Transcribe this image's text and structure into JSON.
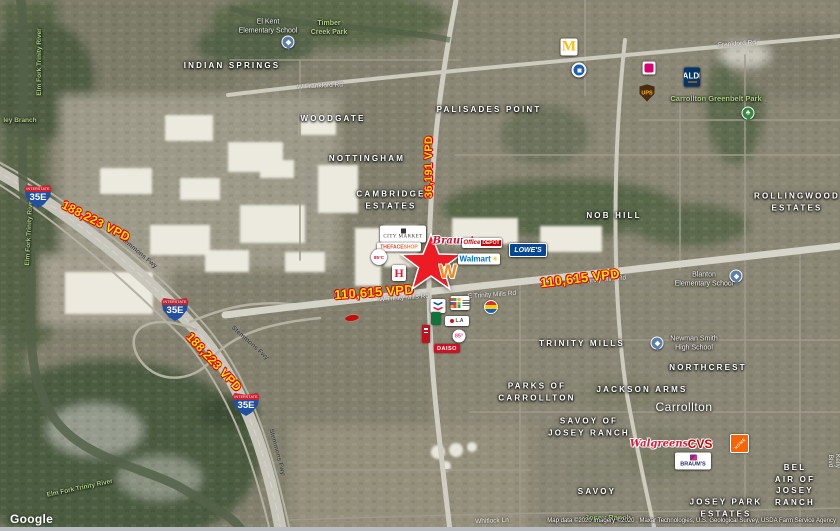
{
  "map": {
    "watermark": "Google",
    "attribution": "Map data ©2020  Imagery ©2020 , Maxar Technologies, U.S. Geological Survey, USDA Farm Service Agency"
  },
  "traffic": {
    "i35e_north": "188,223 VPD",
    "i35e_south": "188,223 VPD",
    "trinity_mills_west": "110,615 VPD",
    "trinity_mills_east": "110,615 VPD",
    "north_south_road": "36,191 VPD"
  },
  "shield": {
    "band": "INTERSTATE",
    "route": "35E"
  },
  "neighborhoods": {
    "indian_springs": "INDIAN SPRINGS",
    "woodgate": "WOODGATE",
    "nottingham": "NOTTINGHAM",
    "cambridge_estates": "CAMBRIDGE\nESTATES",
    "palisades_point": "PALISADES POINT",
    "nob_hill": "NOB HILL",
    "rollingwood_estates": "ROLLINGWOOD\nESTATES",
    "trinity_mills": "TRINITY MILLS",
    "northcrest": "NORTHCREST",
    "parks_of_carrollton": "PARKS OF\nCARROLLTON",
    "jackson_arms": "JACKSON ARMS",
    "savoy_of_josey_ranch": "SAVOY OF\nJOSEY RANCH",
    "savoy": "SAVOY",
    "bel_air_of_josey_ranch": "BEL AIR OF\nJOSEY RANCH",
    "josey_park_estates": "JOSEY PARK\nESTATES",
    "city": "Carrollton"
  },
  "parks": {
    "timber_creek": "Timber\nCreek Park",
    "greenbelt": "Carrollton Greenbelt Park",
    "josey_ranch": "Josey Ranch",
    "elm_fork_1": "Elm Fork Trinity River",
    "elm_fork_2": "Elm Fork Trinity River",
    "elm_fork_3": "Elm Fork Trinity River",
    "ley_branch": "ley Branch"
  },
  "pois": {
    "el_kent": "El Kent\nElementary School",
    "blanton": "Blanton\nElementary School",
    "newman_smith": "Newman Smith\nHigh School"
  },
  "road_labels": {
    "w_frankford": "W Frankford Rd",
    "frankford": "Frankford Rd",
    "w_trinity_mills": "W Trinity Mills Rd",
    "e_trinity_mills_1": "E Trinity Mills Rd",
    "e_trinity_mills_2": "E Trinity Mills Rd",
    "stemmons_1": "Stemmons Fwy",
    "stemmons_2": "Stemmons Fwy",
    "stemmons_3": "Stemmons Fwy",
    "whitlock": "Whitlock Ln",
    "kelly": "Kelly Blvd"
  },
  "brands": {
    "mcdonalds": "M",
    "aldi": "ALDI",
    "ups": "UPS",
    "city_market": "CITY MARKET",
    "faceshop_a": "THEFACE",
    "faceshop_b": "SHOP",
    "cafe_circle": "85°C",
    "hmart": "H",
    "braums_script": "Braum's",
    "office_word": "Office",
    "depot_word": "DEPOT",
    "walmart": "Walmart",
    "walmart_spark": "✶",
    "lowes": "LOWE'S",
    "whataburger": "W",
    "la_sign": "L.A",
    "pink85": "85°",
    "daiso": "DAISO",
    "walgreens": "Walgreens",
    "cvs": "CVS",
    "home_depot": "HOME",
    "braums": "BRAUM'S"
  },
  "icons": {
    "park_tree": "♣"
  }
}
